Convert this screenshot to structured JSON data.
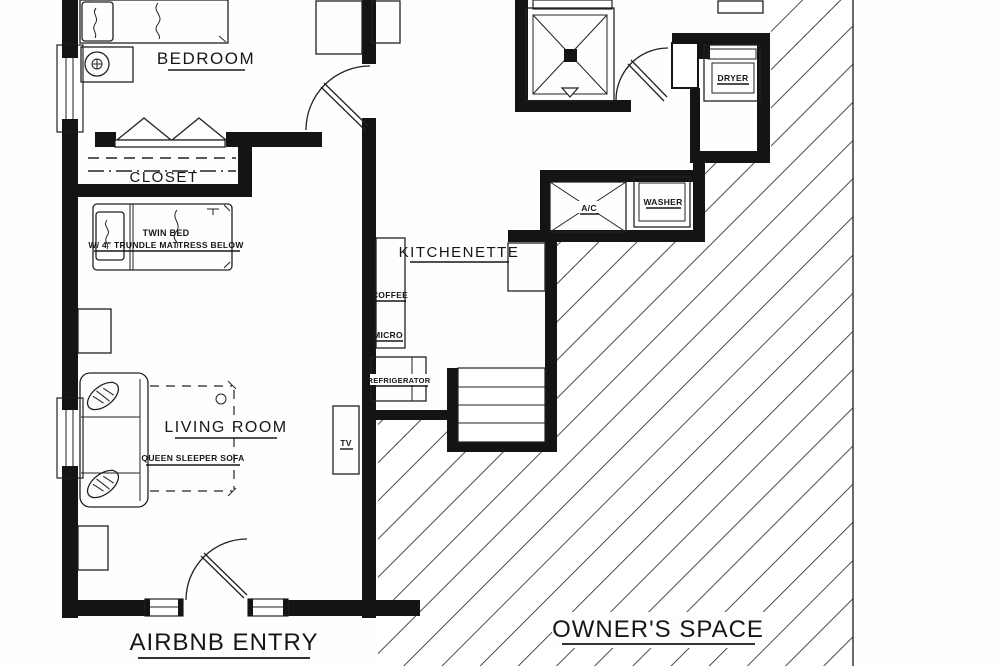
{
  "colors": {
    "ink": "#161616",
    "wall": "#141414",
    "paper": "#fefefe"
  },
  "rooms": {
    "bedroom": "BEDROOM",
    "closet": "CLOSET",
    "kitchenette": "KITCHENETTE",
    "living_room": "LIVING ROOM",
    "airbnb_entry": "AIRBNB ENTRY",
    "owners_space": "OWNER'S SPACE"
  },
  "furniture": {
    "twin_bed": "TWIN BED",
    "trundle_note": "W/ 4\" TRUNDLE MATTRESS BELOW",
    "queen_sofa": "QUEEN SLEEPER SOFA",
    "coffee": "COFFEE",
    "micro": "MICRO",
    "refrigerator": "REFRIGERATOR",
    "tv": "TV",
    "dryer": "DRYER",
    "washer": "WASHER",
    "ac": "A/C"
  }
}
